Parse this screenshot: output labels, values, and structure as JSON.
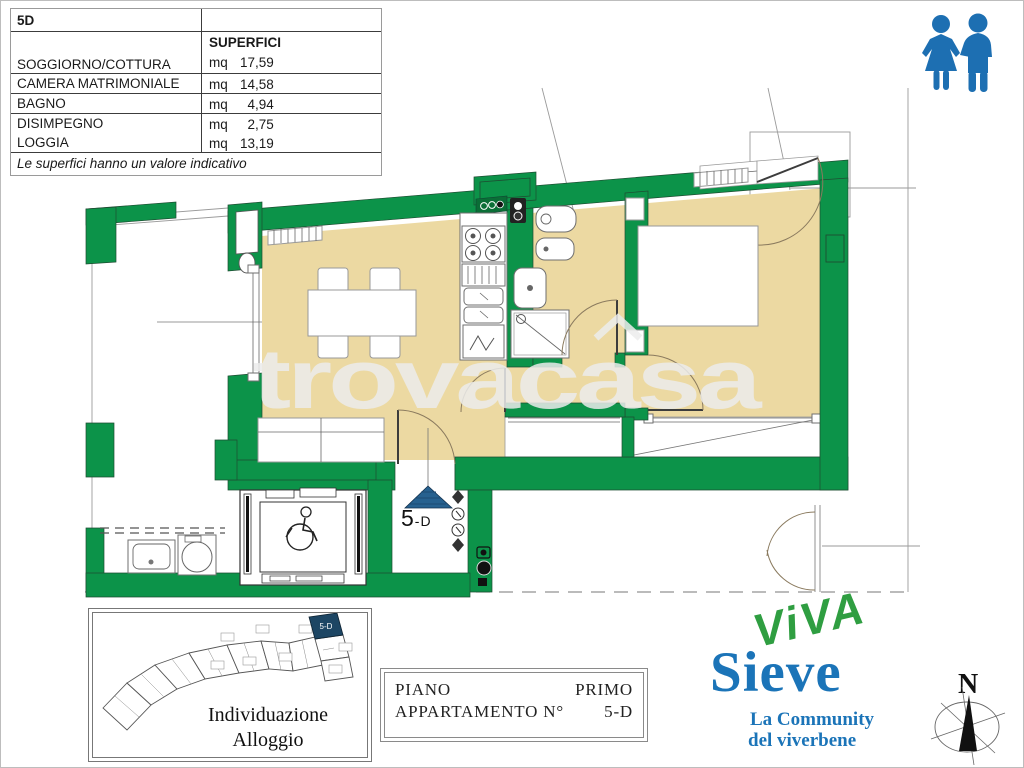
{
  "colors": {
    "wall": "#0c9349",
    "floor": "#ecd9a2",
    "brand_green": "#2f9e41",
    "brand_blue": "#1b74b8",
    "icon_blue": "#1d6fb2",
    "marker_blue": "#27618f",
    "highlight_navy": "#1d4664"
  },
  "area_table": {
    "unit_code": "5D",
    "col_header": "SUPERFICI",
    "rows": [
      {
        "label": "SOGGIORNO/COTTURA",
        "unit": "mq",
        "value": "17,59"
      },
      {
        "label": "CAMERA MATRIMONIALE",
        "unit": "mq",
        "value": "14,58"
      },
      {
        "label": "BAGNO",
        "unit": "mq",
        "value": "4,94"
      },
      {
        "label": "DISIMPEGNO",
        "unit": "mq",
        "value": "2,75"
      },
      {
        "label": "LOGGIA",
        "unit": "mq",
        "value": "13,19"
      }
    ],
    "note": "Le superfici hanno un valore indicativo"
  },
  "plan": {
    "watermark": "trovacasa",
    "unit_number": "5",
    "unit_suffix": "-D"
  },
  "key_plan": {
    "caption_line1": "Individuazione",
    "caption_line2": "Alloggio",
    "highlight_label": "5-D"
  },
  "title_block": {
    "row1_label": "PIANO",
    "row1_value": "PRIMO",
    "row2_label": "APPARTAMENTO N°",
    "row2_value": "5-D"
  },
  "logo": {
    "word1": "ViVA",
    "word2": "Sieve",
    "tagline_line1": "La Community",
    "tagline_line2": "del viverbene"
  },
  "compass": {
    "north_label": "N"
  }
}
